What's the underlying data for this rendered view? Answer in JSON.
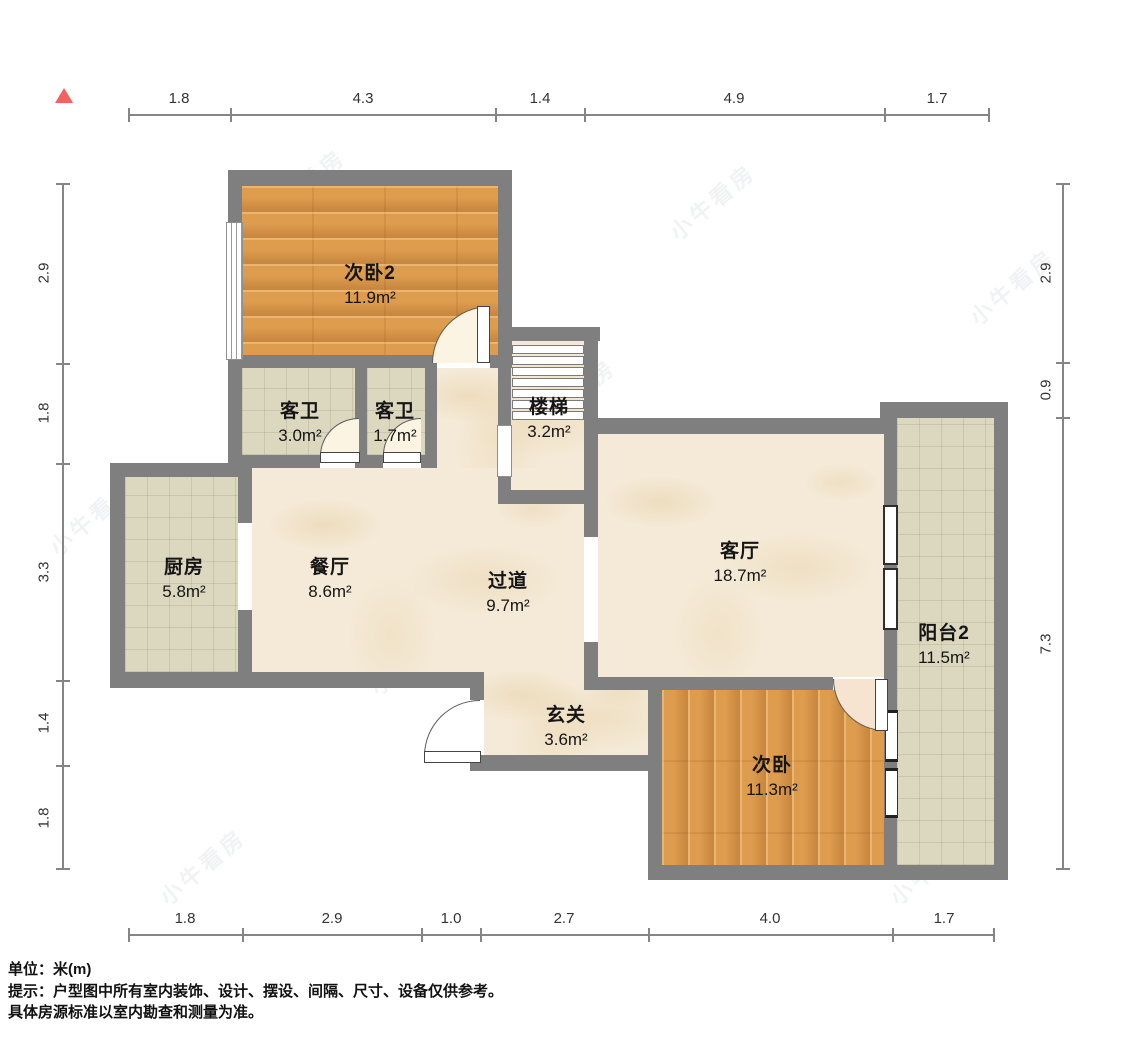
{
  "rooms": [
    {
      "name": "次卧2",
      "area": "11.9m²"
    },
    {
      "name": "客卫",
      "area": "3.0m²"
    },
    {
      "name": "客卫",
      "area": "1.7m²"
    },
    {
      "name": "楼梯",
      "area": "3.2m²"
    },
    {
      "name": "厨房",
      "area": "5.8m²"
    },
    {
      "name": "餐厅",
      "area": "8.6m²"
    },
    {
      "name": "过道",
      "area": "9.7m²"
    },
    {
      "name": "客厅",
      "area": "18.7m²"
    },
    {
      "name": "阳台2",
      "area": "11.5m²"
    },
    {
      "name": "玄关",
      "area": "3.6m²"
    },
    {
      "name": "次卧",
      "area": "11.3m²"
    }
  ],
  "dimensions": {
    "top": [
      "1.8",
      "4.3",
      "1.4",
      "4.9",
      "1.7"
    ],
    "bottom": [
      "1.8",
      "2.9",
      "1.0",
      "2.7",
      "4.0",
      "1.7"
    ],
    "left": [
      "2.9",
      "1.8",
      "3.3",
      "1.4",
      "1.8"
    ],
    "right": [
      "2.9",
      "0.9",
      "7.3"
    ]
  },
  "footer": {
    "unit": "单位：米(m)",
    "tip": "提示：户型图中所有室内装饰、设计、摆设、间隔、尺寸、设备仅供参考。",
    "tip2": "具体房源标准以室内勘查和测量为准。"
  },
  "watermark": "小牛看房",
  "colors": {
    "wall": "#7f7f7f",
    "wood_floor": "#dd9c4e",
    "marble_floor": "#f4ead7",
    "tile_floor": "#dcd8bf",
    "north_marker": "#f8605f",
    "dimension_line": "#858585"
  }
}
